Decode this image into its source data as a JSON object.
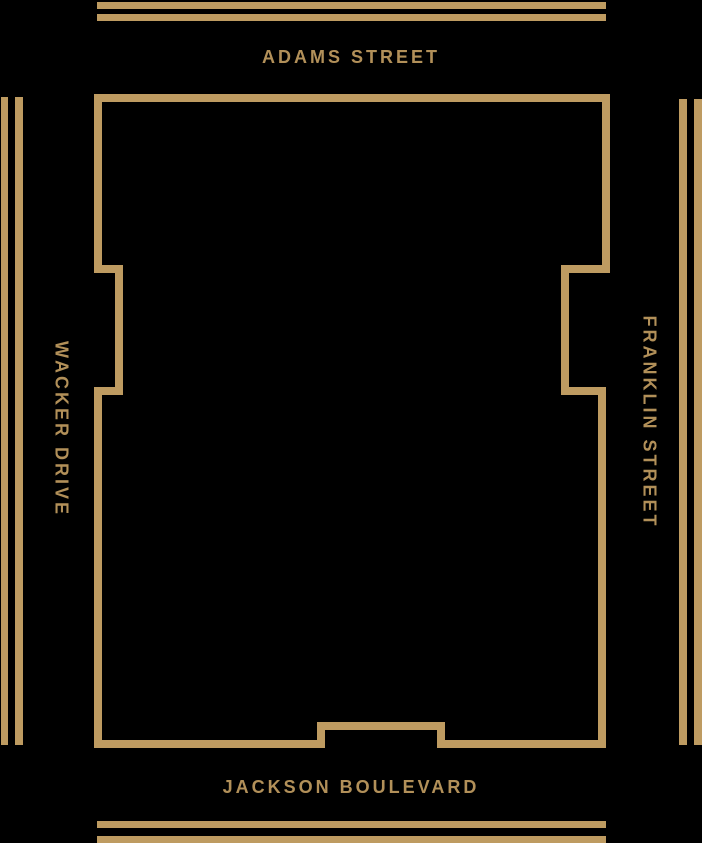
{
  "colors": {
    "background": "#000000",
    "line_gold": "#BE9B61",
    "text_gold": "#B29059"
  },
  "streets": {
    "adams": {
      "label": "ADAMS STREET"
    },
    "jackson": {
      "label": "JACKSON BOULEVARD"
    },
    "wacker": {
      "label": "WACKER DRIVE"
    },
    "franklin": {
      "label": "FRANKLIN STREET"
    }
  }
}
